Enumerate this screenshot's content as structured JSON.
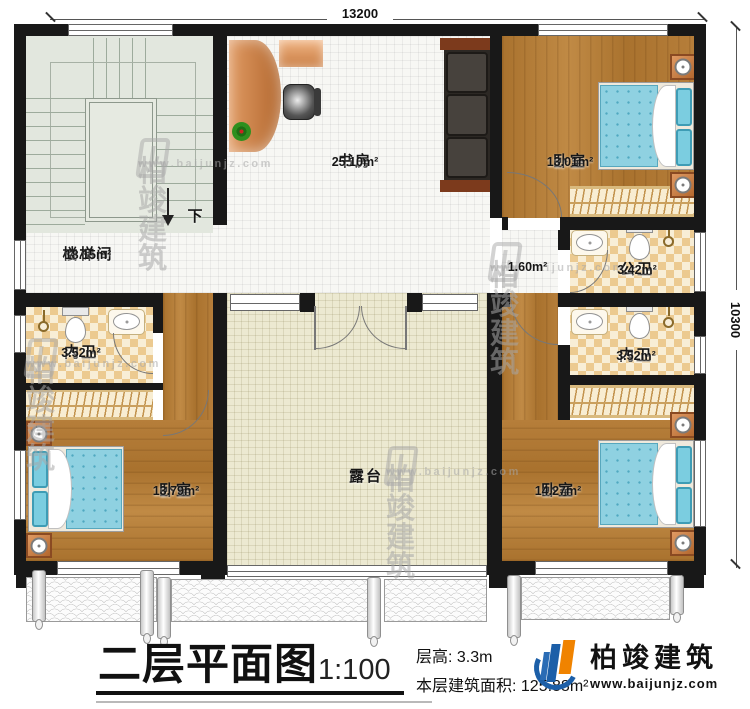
{
  "dimensions": {
    "top": "13200",
    "right": "10300"
  },
  "rooms": {
    "stairwell": {
      "label": "楼梯间",
      "area": "18.15m²"
    },
    "study": {
      "label": "书房",
      "area": "25.10m²"
    },
    "bedroom_ne": {
      "label": "卧室",
      "area": "13.01m²"
    },
    "public_bath": {
      "label": "公卫",
      "area": "3.42m²"
    },
    "inner_bath_right": {
      "label": "内卫",
      "area": "3.52m²"
    },
    "inner_bath_left": {
      "label": "内卫",
      "area": "3.52m²"
    },
    "bedroom_sw": {
      "label": "卧室",
      "area": "13.79m²"
    },
    "bedroom_se": {
      "label": "卧室",
      "area": "14.27m²"
    },
    "terrace": {
      "label": "露台"
    },
    "hall_niche": {
      "area": "1.60m²"
    }
  },
  "stairs": {
    "down_label": "下"
  },
  "title_block": {
    "title": "二层平面图",
    "scale": "1:100",
    "floor_height": "层高: 3.3m",
    "floor_area": "本层建筑面积: 125.88m²"
  },
  "brand": {
    "name": "柏竣建筑",
    "website": "www.baijunjz.com"
  },
  "watermark": {
    "name": "柏竣建筑",
    "website": "www.baijunjz.com"
  },
  "colors": {
    "wall": "#181818",
    "brand_blue": "#1c5fa8",
    "brand_orange": "#f08300",
    "wood": "#b07a39",
    "mattress": "#8fd1e1",
    "bath_tile": "#ecca90"
  }
}
